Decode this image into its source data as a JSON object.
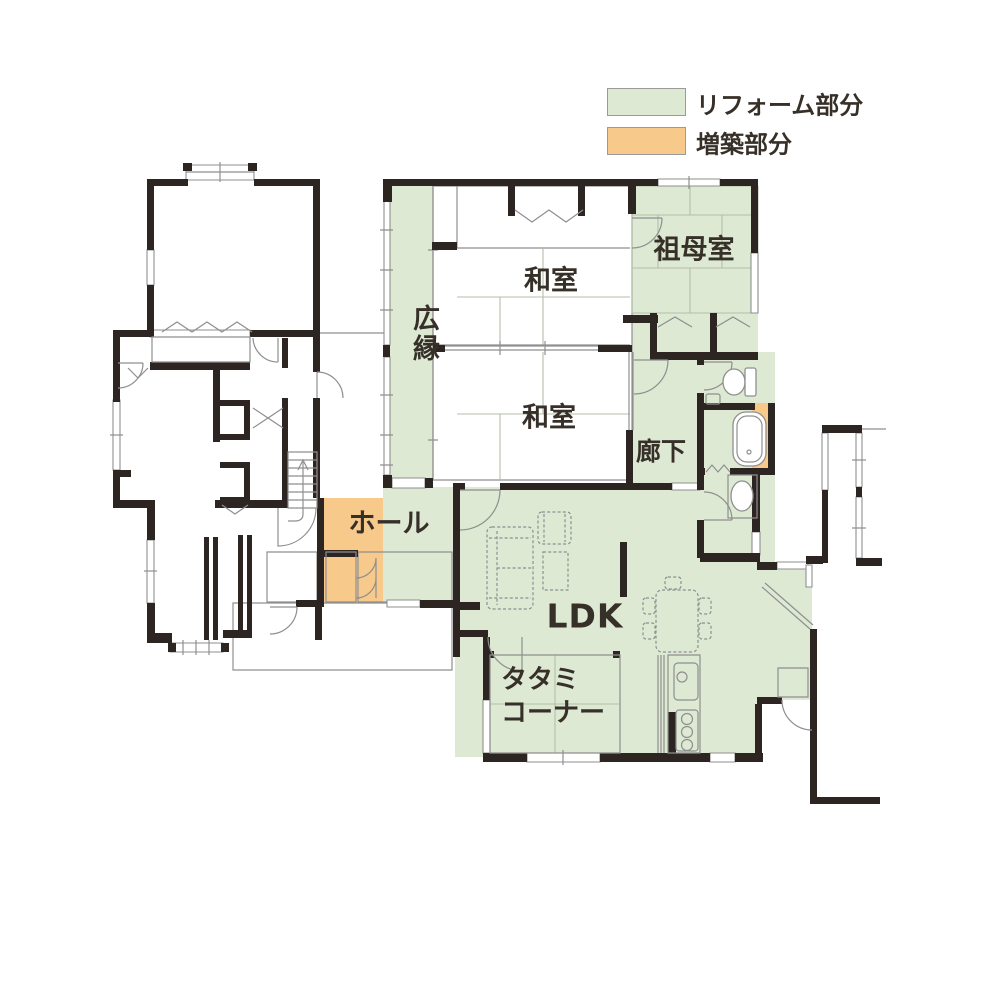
{
  "title": "リフォーム間取り図（1階）",
  "legend": {
    "items": [
      {
        "key": "reform",
        "label": "リフォーム部分",
        "color": "#dde9d3"
      },
      {
        "key": "extension",
        "label": "増築部分",
        "color": "#f7c98b"
      }
    ]
  },
  "rooms": {
    "hiroen": "広縁",
    "washitsu_upper": "和室",
    "washitsu_lower": "和室",
    "sobo_room": "祖母室",
    "rouka": "廊下",
    "hall": "ホール",
    "ldk": "LDK",
    "tatami_corner": "タタミ\nコーナー"
  },
  "icons": [
    "bathtub-icon",
    "toilet-icon",
    "washbasin-icon",
    "kitchen-sink-icon",
    "stove-icon",
    "sofa-icon",
    "armchair-icon",
    "coffee-table-icon",
    "dining-table-icon",
    "refrigerator-icon",
    "stairs-icon"
  ],
  "colors": {
    "reform_green": "#dde9d3",
    "extension_orange": "#f7c98b",
    "wall": "#2d2522",
    "thin_line": "#8f8f8f",
    "tatami_line": "#b3bfa8",
    "text": "#373029",
    "legend_border": "#9b9b9b"
  }
}
